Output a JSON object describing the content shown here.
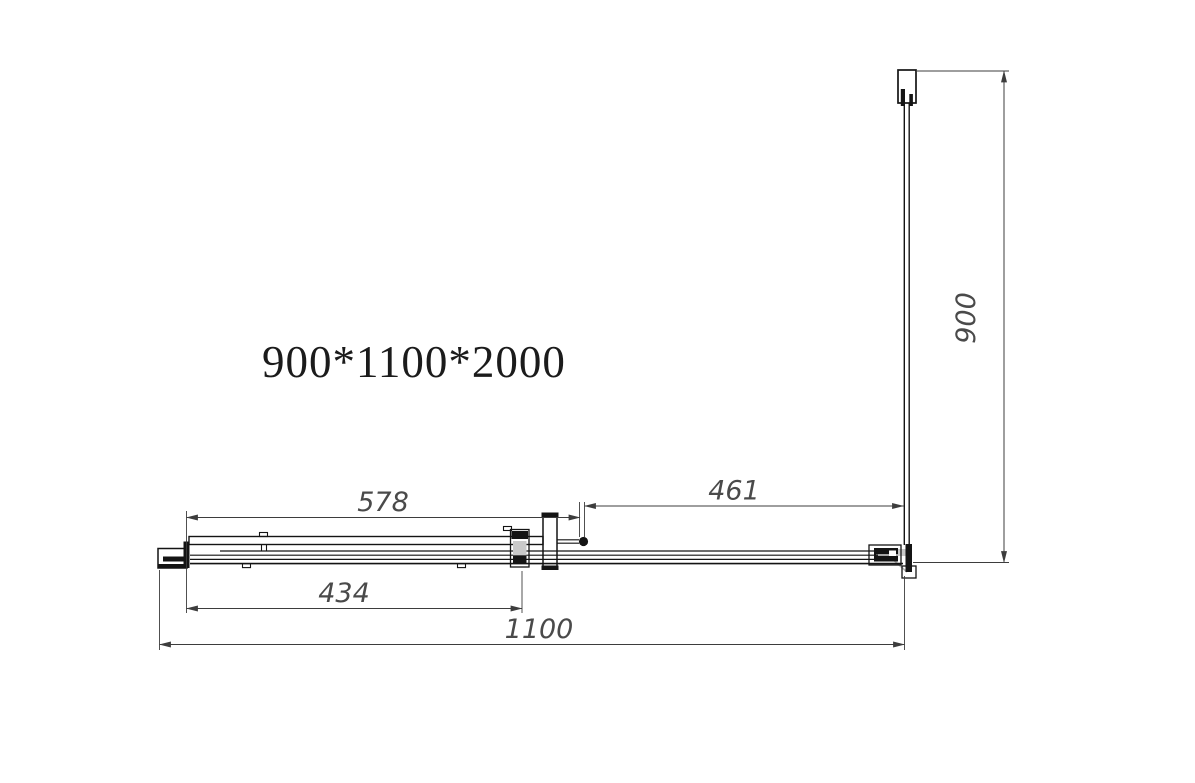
{
  "title": "900*1100*2000",
  "drawing": {
    "dimensions": {
      "door_panel_width": "578",
      "fixed_panel_width": "461",
      "door_opening_width": "434",
      "total_width": "1100",
      "side_depth": "900"
    },
    "colors": {
      "line": "#141414",
      "dimension_text": "#4a4a4a",
      "background": "#ffffff"
    }
  }
}
